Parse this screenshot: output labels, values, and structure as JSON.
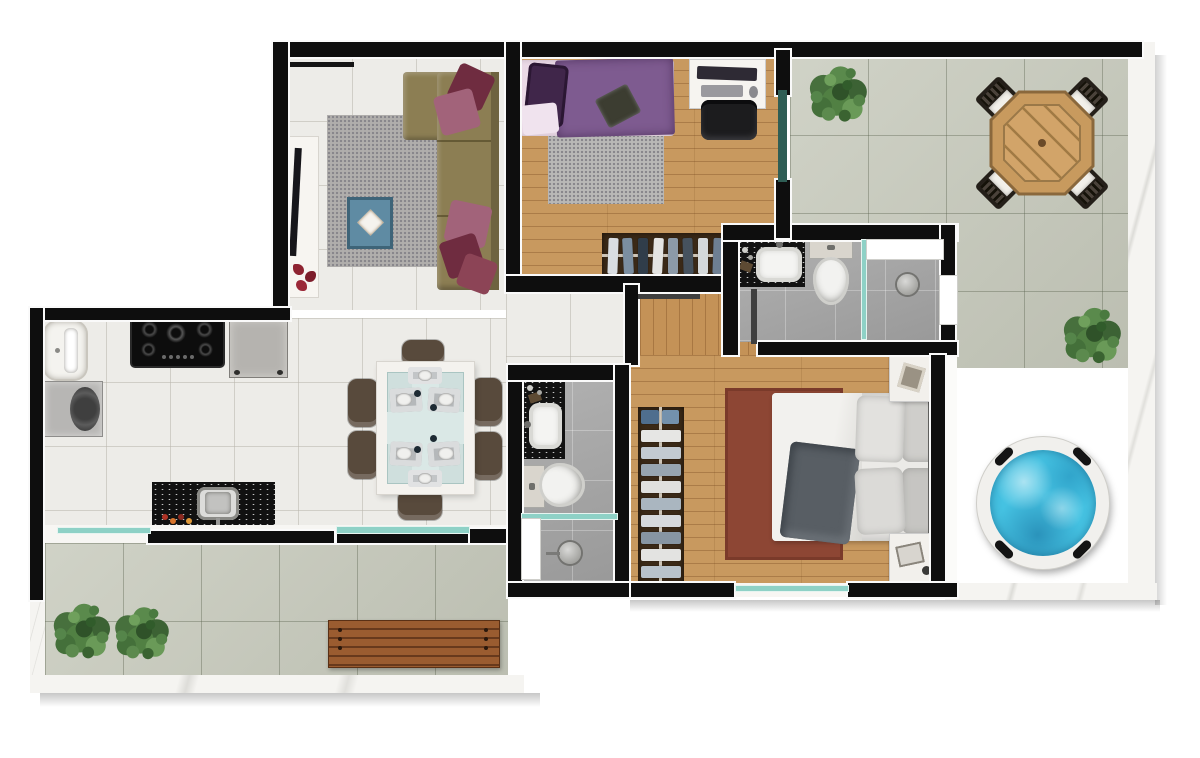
{
  "scene": {
    "type": "apartment floor plan – photorealistic top-down 3D render",
    "background_color": "#ffffff",
    "wall_color": "#0e0e0e",
    "trim_color": "#fafafa",
    "no_visible_text": true
  },
  "palette": {
    "white_tile_floor": "#edece8",
    "wood_floor": "#c8995f",
    "gray_bathroom_floor": "#a6a6a6",
    "concrete_terrace_tile": "#c7cabc",
    "wood_deck": "#7d4c34",
    "marble_border": "#f5f4f1",
    "glass_partition": "#8ed1c6",
    "dark_glass_door": "#2f5e55",
    "granite_counter": "#121212",
    "hot_tub_water": "#45c2e2"
  },
  "rooms": [
    {
      "id": "living_room",
      "label": "Living room",
      "floor": "white ceramic tile",
      "furniture": [
        {
          "name": "tv-sideboard",
          "color": "#f7f5f1",
          "decor": "red petals"
        },
        {
          "name": "flat-tv",
          "color": "#17161a"
        },
        {
          "name": "gray-shag-rug",
          "color": "#aaa8a6"
        },
        {
          "name": "coffee-table",
          "color": "#5f8ba3",
          "decor": "white diamond tray"
        },
        {
          "name": "l-shaped-sofa",
          "color": "#8c7e53",
          "cushion_colors": [
            "#6f2c40",
            "#a2637a"
          ]
        }
      ]
    },
    {
      "id": "kitchen",
      "label": "Kitchen",
      "floor": "white ceramic tile",
      "furniture": [
        {
          "name": "laundry-tub",
          "color": "#f4f3ef"
        },
        {
          "name": "washing-machine",
          "color": "#b7b6b4"
        },
        {
          "name": "gas-cooktop",
          "color": "#0d0d0d",
          "burners": 4
        },
        {
          "name": "cabinet",
          "color": "#b5b3af"
        },
        {
          "name": "island-counter",
          "color": "#121212",
          "detail": "steel sink + red spice jars"
        }
      ]
    },
    {
      "id": "dining_area",
      "label": "Dining area",
      "floor": "white ceramic tile",
      "furniture": [
        {
          "name": "dining-table",
          "top": "glass",
          "frame_color": "#f4f2ee",
          "glass_color": "#cfdfdd",
          "place_settings": 6
        },
        {
          "name": "dining-chairs",
          "count": 6,
          "color": "#584a3c"
        }
      ]
    },
    {
      "id": "bedroom_1",
      "label": "Bedroom 1",
      "floor": "light oak wood",
      "furniture": [
        {
          "name": "single-bed",
          "duvet_color": "#7e5b90",
          "pillow_color": "#40264a",
          "sheet_color": "#ead9e6"
        },
        {
          "name": "gray-shag-rug",
          "color": "#b9b8b6"
        },
        {
          "name": "desk",
          "color": "#f6f4f0",
          "items": [
            "monitor",
            "keyboard",
            "mouse"
          ]
        },
        {
          "name": "office-chair",
          "color": "#1c1c1e"
        },
        {
          "name": "clothes-rack",
          "color": "#3a2917",
          "items": "hanging clothes"
        }
      ]
    },
    {
      "id": "bathroom_1",
      "label": "Bathroom 1",
      "floor": "gray tile",
      "fixtures": [
        {
          "name": "sink-counter",
          "counter_color": "#121212",
          "basin_color": "#f4f4f2"
        },
        {
          "name": "toilet",
          "color": "#f2f2f0"
        },
        {
          "name": "walk-in-shower",
          "divider": "glass",
          "drain": "round metal",
          "niche_color": "#ffffff"
        }
      ]
    },
    {
      "id": "hallway",
      "label": "Hallway",
      "floor": "light oak wood",
      "fixtures": [
        {
          "name": "open-door-leaves",
          "count": 2
        }
      ]
    },
    {
      "id": "bathroom_2",
      "label": "Bathroom 2",
      "floor": "gray tile",
      "fixtures": [
        {
          "name": "sink-counter",
          "counter_color": "#121212",
          "basin_color": "#f4f4f2"
        },
        {
          "name": "toilet",
          "color": "#f2f2f0"
        },
        {
          "name": "walk-in-shower",
          "divider": "glass",
          "door": "white",
          "head": "round metal"
        }
      ]
    },
    {
      "id": "bedroom_2",
      "label": "Bedroom 2",
      "floor": "light oak wood",
      "furniture": [
        {
          "name": "double-bed",
          "duvet_color": "#ebeae7",
          "throw_color": "#585e64",
          "headboard_color": "#5f5f5d"
        },
        {
          "name": "terracotta-rug",
          "color": "#8d4634"
        },
        {
          "name": "clothes-rack",
          "color": "#3a2917",
          "items": "hanging shirts + blue boxes"
        },
        {
          "name": "nightstand",
          "count": 2,
          "color": "#f2f0ec"
        }
      ]
    }
  ],
  "outdoor": [
    {
      "id": "terrace_top",
      "label": "Terrace (top right)",
      "floor": "concrete tiles",
      "items": [
        {
          "name": "octagonal-wood-table",
          "color": "#c89a5e"
        },
        {
          "name": "cushioned-chairs",
          "count": 4,
          "cushion_color": "#f2f0ea"
        },
        {
          "name": "shrub",
          "count": 2,
          "color": "#4a7340"
        }
      ]
    },
    {
      "id": "deck",
      "label": "Hot-tub deck",
      "floor": "dark wood planks",
      "items": [
        {
          "name": "hot-tub",
          "ring_color": "#f1f0ed",
          "water_color": "#45c2e2",
          "handles": 4
        }
      ]
    },
    {
      "id": "terrace_bottom",
      "label": "Terrace (bottom left)",
      "floor": "concrete tiles",
      "items": [
        {
          "name": "wood-slat-bench",
          "color": "#9a5c30"
        },
        {
          "name": "shrub",
          "count": 2,
          "color": "#4a7340"
        }
      ]
    }
  ]
}
